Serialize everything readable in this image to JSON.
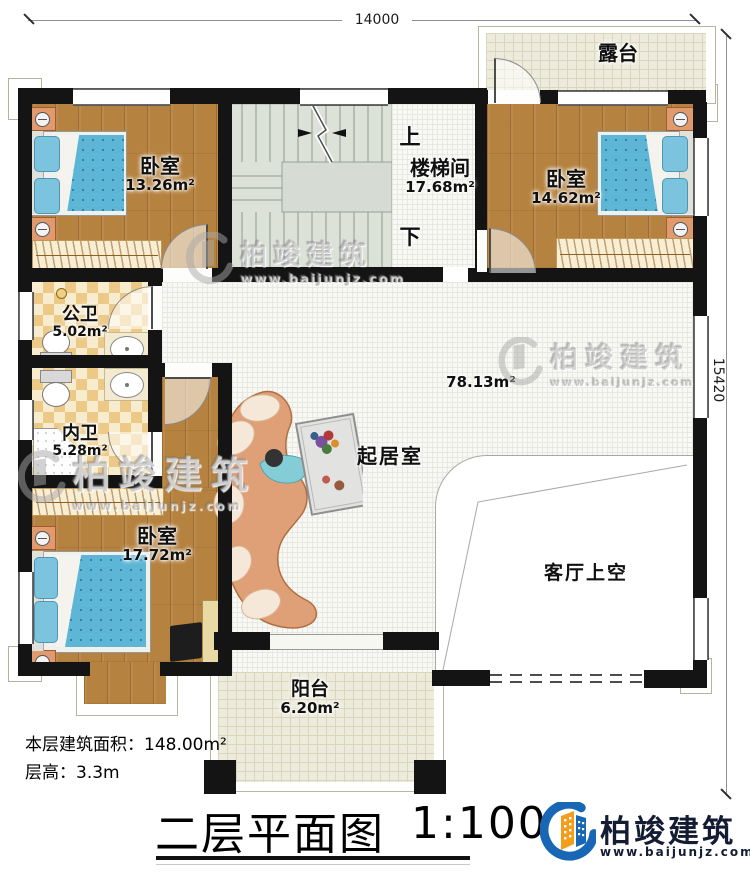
{
  "dimensions": {
    "width_mm": "14000",
    "height_mm": "15420"
  },
  "rooms": {
    "terrace": {
      "name": "露台"
    },
    "bedroom_top_left": {
      "name": "卧室",
      "area": "13.26m²"
    },
    "stairwell": {
      "name": "楼梯间",
      "area": "17.68m²",
      "up_label": "上",
      "down_label": "下"
    },
    "bedroom_top_right": {
      "name": "卧室",
      "area": "14.62m²"
    },
    "public_bathroom": {
      "name": "公卫",
      "area": "5.02m²"
    },
    "private_bathroom": {
      "name": "内卫",
      "area": "5.28m²"
    },
    "bedroom_bottom_left": {
      "name": "卧室",
      "area": "17.72m²"
    },
    "living_room": {
      "name": "起居室",
      "area": "78.13m²"
    },
    "living_void": {
      "name": "客厅上空"
    },
    "balcony": {
      "name": "阳台",
      "area": "6.20m²"
    }
  },
  "info": {
    "floor_area": "本层建筑面积：148.00m²",
    "floor_height": "层高：3.3m"
  },
  "title": {
    "text": "二层平面图",
    "scale": "1:100"
  },
  "brand": {
    "name": "柏竣建筑",
    "url": "www.baijunjz.com"
  },
  "watermark": {
    "name": "柏竣建筑",
    "url": "www.baijunjz.com"
  },
  "colors": {
    "wall": "#141414",
    "wood_floor": "#b5823f",
    "tile_checker": "#ecc987",
    "mattress_blue": "#5db6d6",
    "stair_gray": "#dde2d9",
    "terrace_tile": "#edebdb",
    "brand_blue": "#1867b5",
    "brand_orange": "#f49d1d",
    "brand_navy": "#141c33"
  }
}
